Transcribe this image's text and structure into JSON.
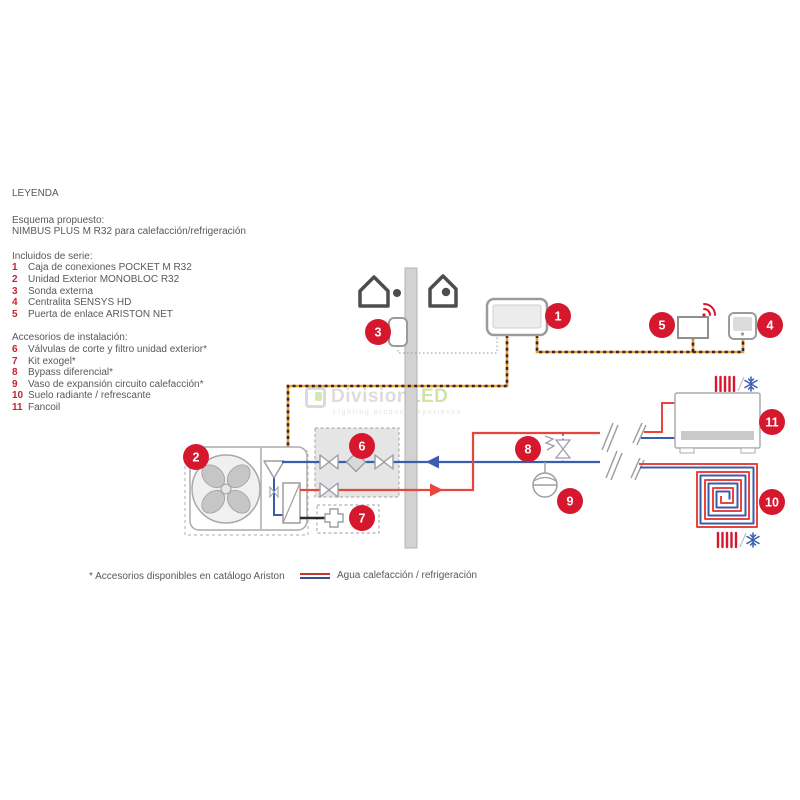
{
  "legend": {
    "title": "LEYENDA",
    "scheme_label": "Esquema propuesto:",
    "scheme_name": "NIMBUS PLUS M R32 para calefacción/refrigeración",
    "included_header": "Incluidos de serie:",
    "included": [
      {
        "n": "1",
        "label": "Caja de conexiones POCKET M R32"
      },
      {
        "n": "2",
        "label": "Unidad Exterior MONOBLOC R32"
      },
      {
        "n": "3",
        "label": "Sonda externa"
      },
      {
        "n": "4",
        "label": "Centralita SENSYS HD"
      },
      {
        "n": "5",
        "label": "Puerta de enlace ARISTON NET"
      }
    ],
    "accessories_header": "Accesorios de instalación:",
    "accessories": [
      {
        "n": "6",
        "label": "Válvulas de corte y filtro unidad exterior*"
      },
      {
        "n": "7",
        "label": "Kit exogel*"
      },
      {
        "n": "8",
        "label": "Bypass diferencial*"
      },
      {
        "n": "9",
        "label": "Vaso de expansión circuito calefacción*"
      },
      {
        "n": "10",
        "label": "Suelo radiante / refrescante"
      },
      {
        "n": "11",
        "label": "Fancoil"
      }
    ]
  },
  "footer": {
    "note": "* Accesorios disponibles en catálogo Ariston",
    "water_label": "Agua calefacción / refrigeración"
  },
  "watermark": {
    "brand_gray": "Division",
    "brand_green": "LED",
    "tagline": "Lighting product experience"
  },
  "colors": {
    "accent_red": "#d6182f",
    "pipe_red": "#e8453c",
    "pipe_blue": "#3a5dae",
    "bus_orange": "#f29a2e",
    "text_gray": "#58595b"
  }
}
